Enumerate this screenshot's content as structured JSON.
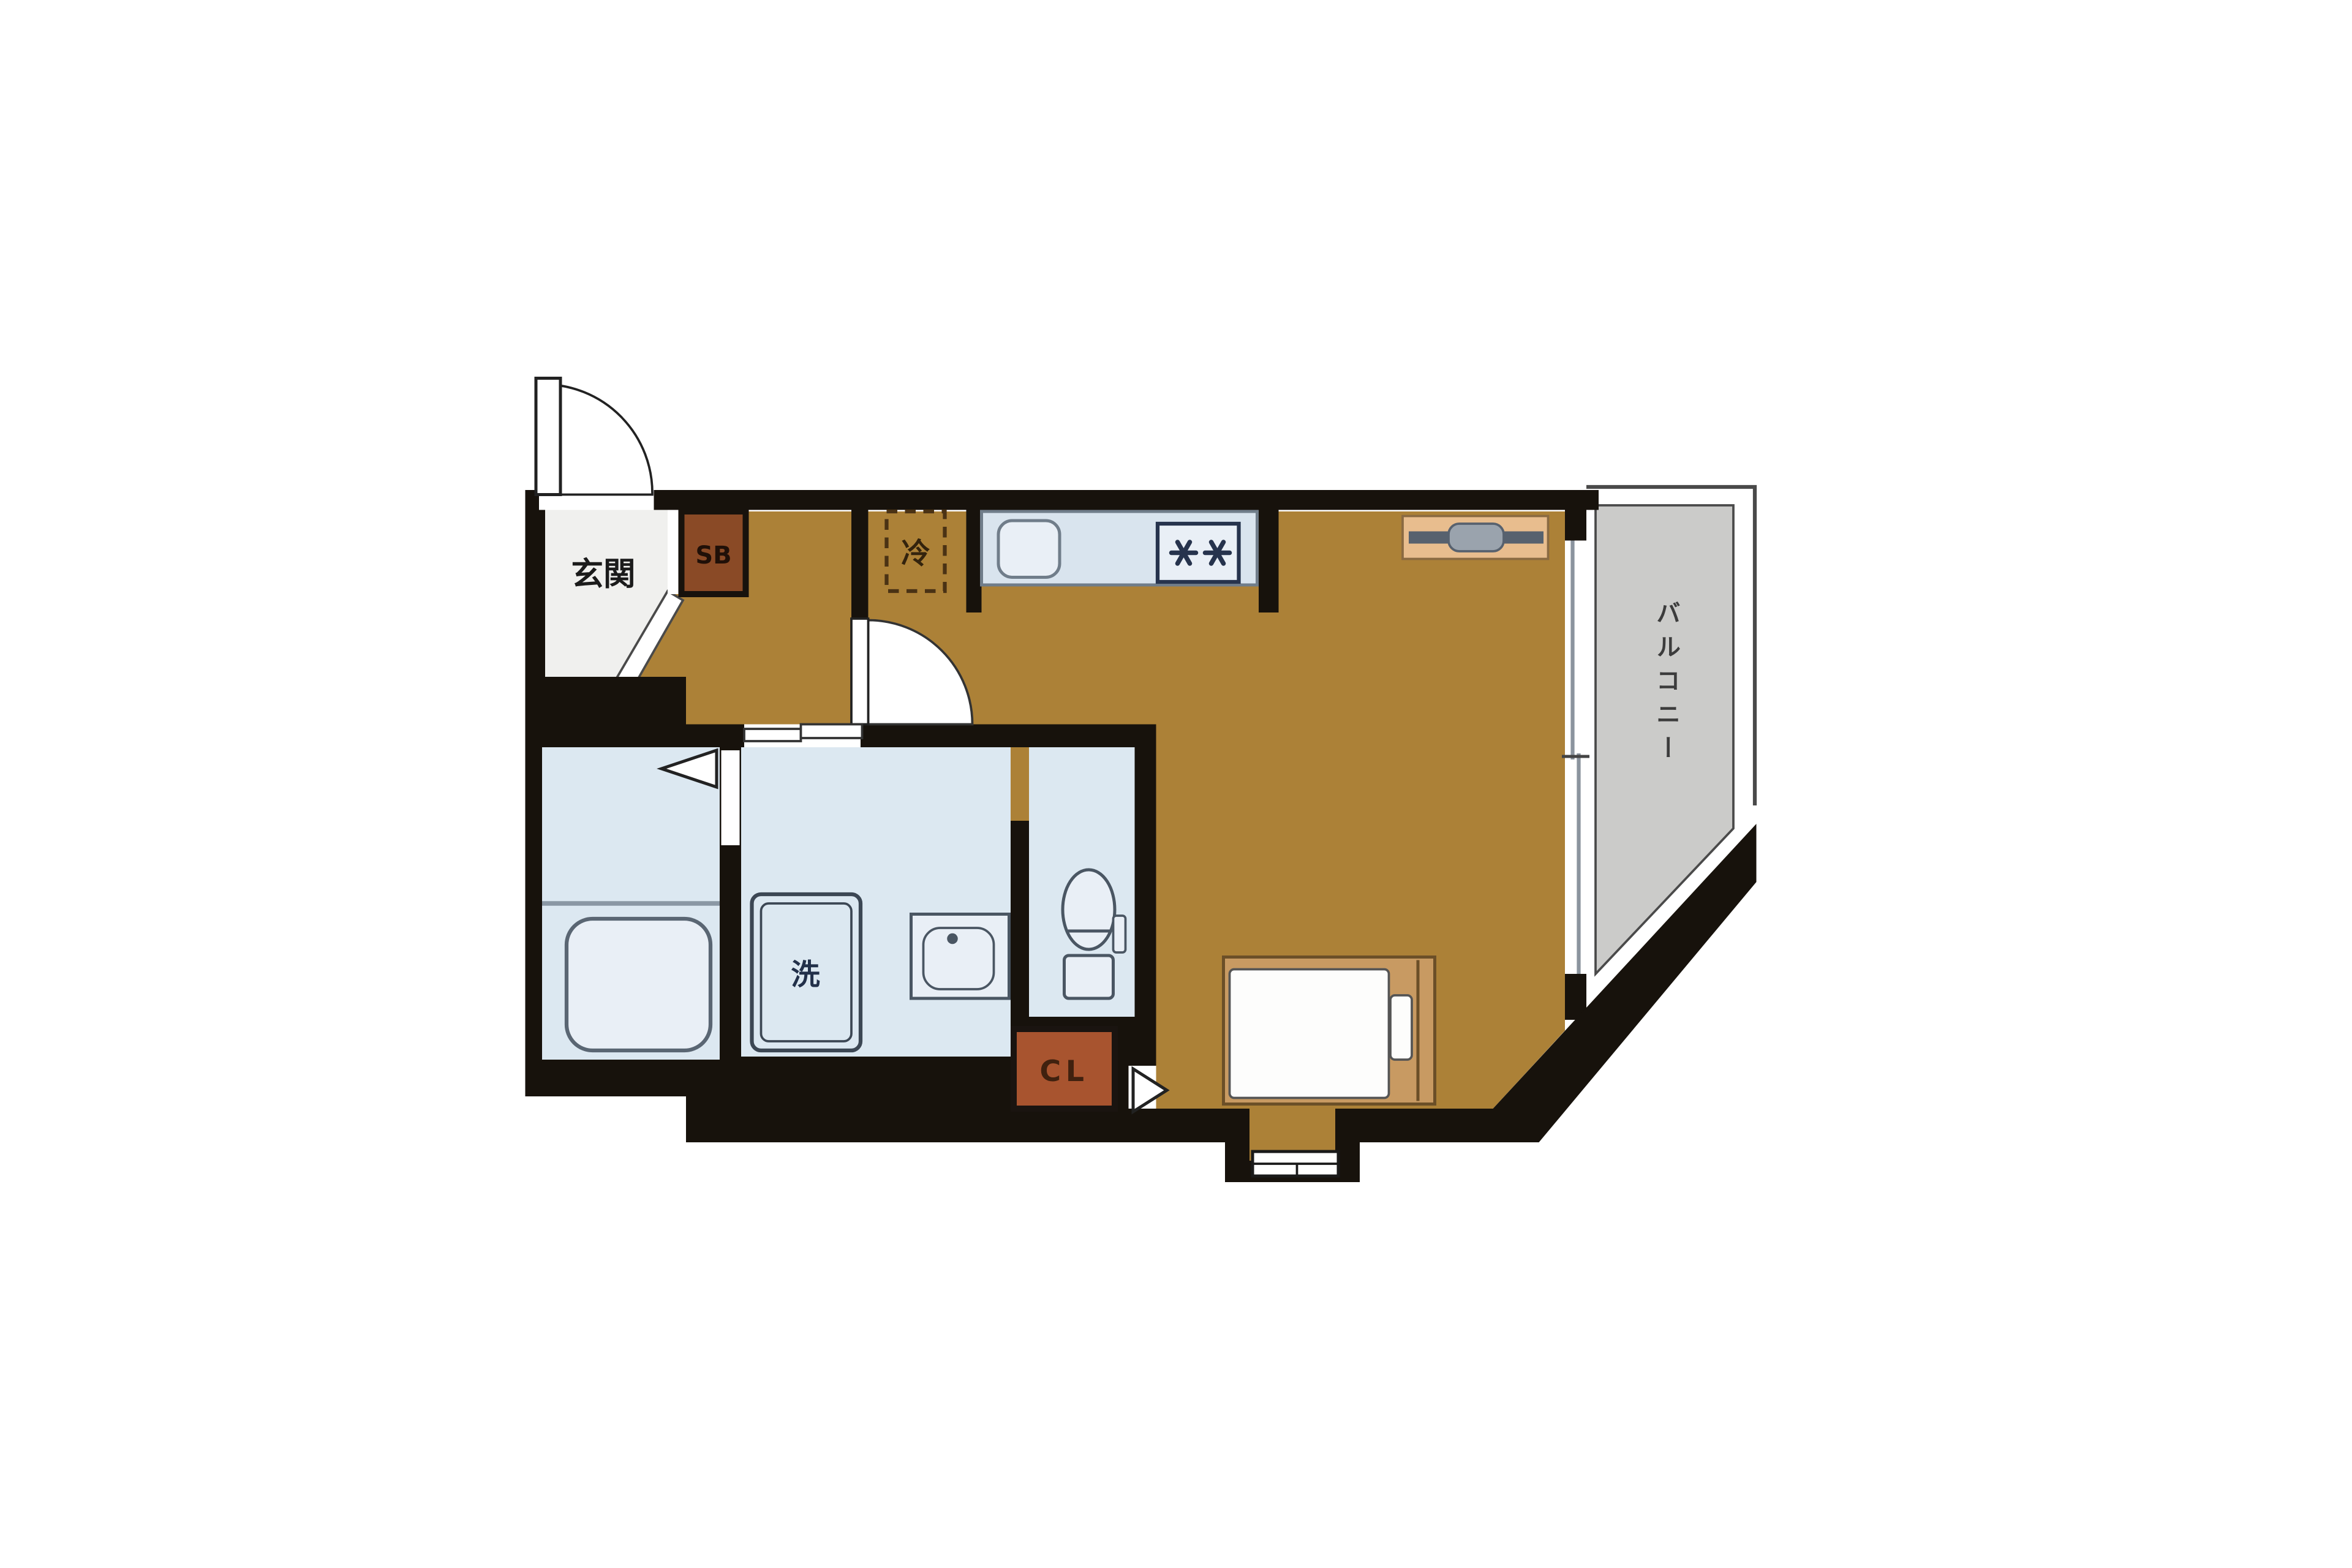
{
  "plan": {
    "type": "apartment-floor-plan",
    "labels": {
      "entrance": "玄関",
      "shoe_box": "SB",
      "refrigerator": "冷",
      "washing_machine": "洗",
      "closet": "CL",
      "balcony": "バルコニー"
    },
    "colors": {
      "wall": "#17120c",
      "flooring": "#ac8137",
      "wet_area_floor": "#dce8f1",
      "entrance_floor": "#f0f0ee",
      "balcony_floor": "#cbcbc9",
      "closet_fill": "#a8542f",
      "shoe_box_fill": "#8a4a26",
      "counter_fill": "#d9e4ee",
      "fixture_fill": "#e9eff6",
      "bed_frame": "#c89a62",
      "mattress": "#fdfdfc",
      "desk_fill": "#e8bd8e",
      "desk_bar": "#57616e",
      "desk_handle": "#9aa3ad",
      "burner": "#26334d"
    }
  }
}
